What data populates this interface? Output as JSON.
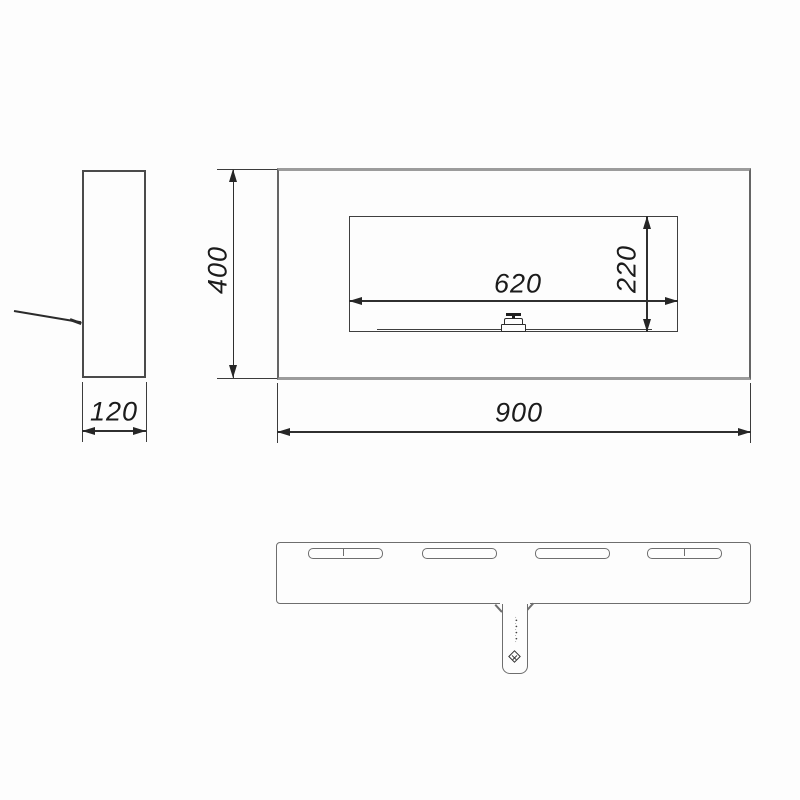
{
  "drawing": {
    "dimensions": {
      "front_width": "900",
      "front_height": "400",
      "side_depth": "120",
      "opening_width": "620",
      "opening_height": "220"
    },
    "tab": {
      "engraving": "·•·•·•·•·"
    }
  }
}
